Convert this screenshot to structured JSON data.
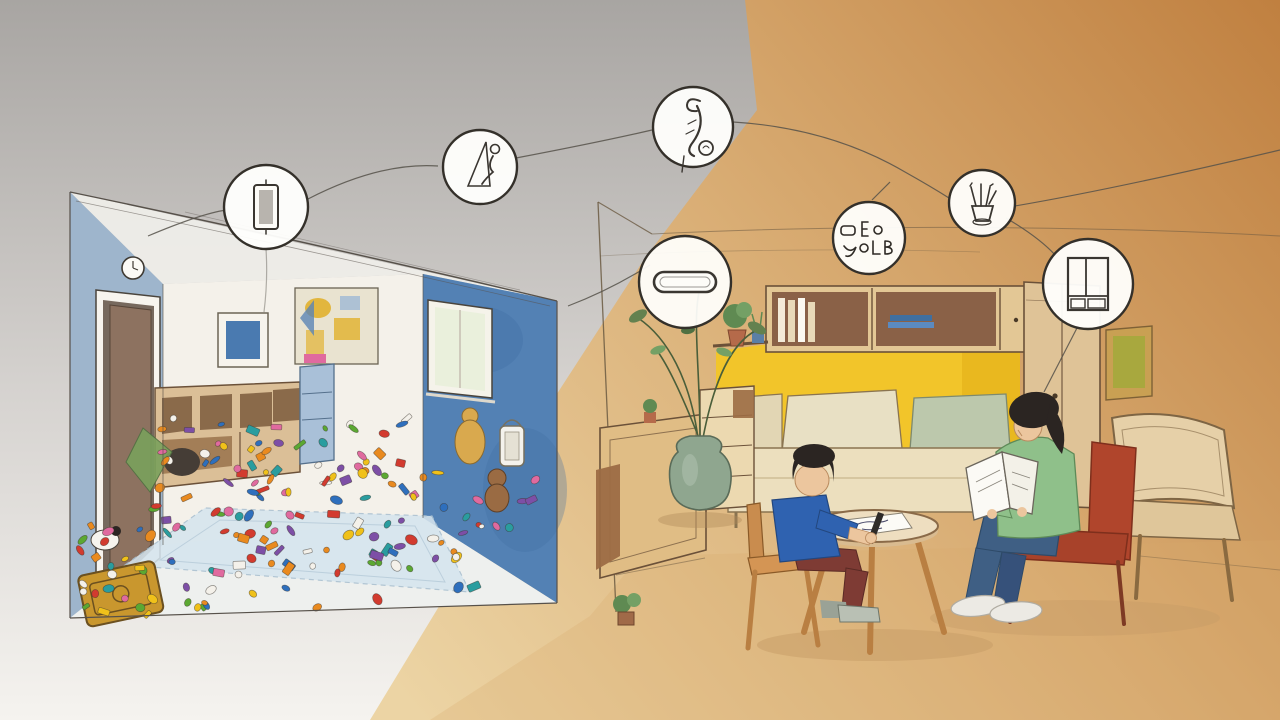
{
  "scene": {
    "type": "watercolor-illustration",
    "left_room": "messy-playroom",
    "right_room": "tidy-reading-room",
    "figures": [
      "boy-drawing-at-round-table",
      "woman-reading-in-red-chair"
    ]
  },
  "badges": [
    {
      "icon": "rolled-mat-icon"
    },
    {
      "icon": "slide-figure-icon"
    },
    {
      "icon": "hanging-squiggle-icon"
    },
    {
      "icon": "wall-slot-icon"
    },
    {
      "icon": "letter-labels-icon"
    },
    {
      "icon": "pencil-cup-icon"
    },
    {
      "icon": "wardrobe-icon"
    }
  ],
  "palette": {
    "bgWarmDeep": "#c08040",
    "bgWarmMid": "#d9ad74",
    "bgWarmPale": "#ecd4a4",
    "bgGrayTop": "#a8a5a2",
    "bgGrayMid": "#d6d3d0",
    "bgGrayPale": "#f5f3ef",
    "leftWallBlue": "#9eb5cc",
    "accentWallBlue": "#5381b4",
    "accentWallDeep": "#3e6da3",
    "backWallWhite": "#f4f1ea",
    "doorBrown": "#8d7260",
    "doorDark": "#77695e",
    "rugBlue": "#d6e5ee",
    "nookYellow": "#f2c52a",
    "nookDeep": "#e2ad15",
    "woodLight": "#e3c795",
    "woodMid": "#cf9254",
    "woodDark": "#9c6b44",
    "wardrobeTan": "#dfc397",
    "chairRed": "#b0452c",
    "loungeTan": "#e6d0a8",
    "sweaterGreen": "#8fc08a",
    "jeansBlue": "#3f5f84",
    "shirtBlue": "#2f62b0",
    "pantsMaroon": "#7e3b34",
    "skinTone": "#ecc69e",
    "hairDark": "#2b2522",
    "vaseGreen": "#8fa68f",
    "plantGreen": "#63814f",
    "pillowCream": "#e8e0c4",
    "pillowSage": "#bcc8ac",
    "suitcaseYellow": "#c9972e",
    "posterCream": "#e9e3d0",
    "posterYellow": "#e2b63e",
    "pictureBlue": "#4a7ab0",
    "pictureOlive": "#a8a83e",
    "frameGold": "#c9a053",
    "mattressCream": "#ecdfbe",
    "chestCream": "#ecd9b0",
    "sideboardTan": "#e0bd85",
    "tableCream": "#eedec0",
    "shadowWarm": "#c59c66",
    "shoeGray": "#b9c0b4",
    "sneakerWhite": "#eceae4",
    "lanternWhite": "#f4f2ec",
    "figureGold": "#d9a94e",
    "bookWhite": "#fbfaf5",
    "outlineInk": "#3f3a33"
  },
  "toys": {
    "count": 176,
    "colors": [
      "#d23b2f",
      "#e98a1f",
      "#f0c11a",
      "#5ba832",
      "#2a9d9f",
      "#2e6fbd",
      "#e06a9f",
      "#7d4fa6",
      "#f4f1ea"
    ]
  }
}
